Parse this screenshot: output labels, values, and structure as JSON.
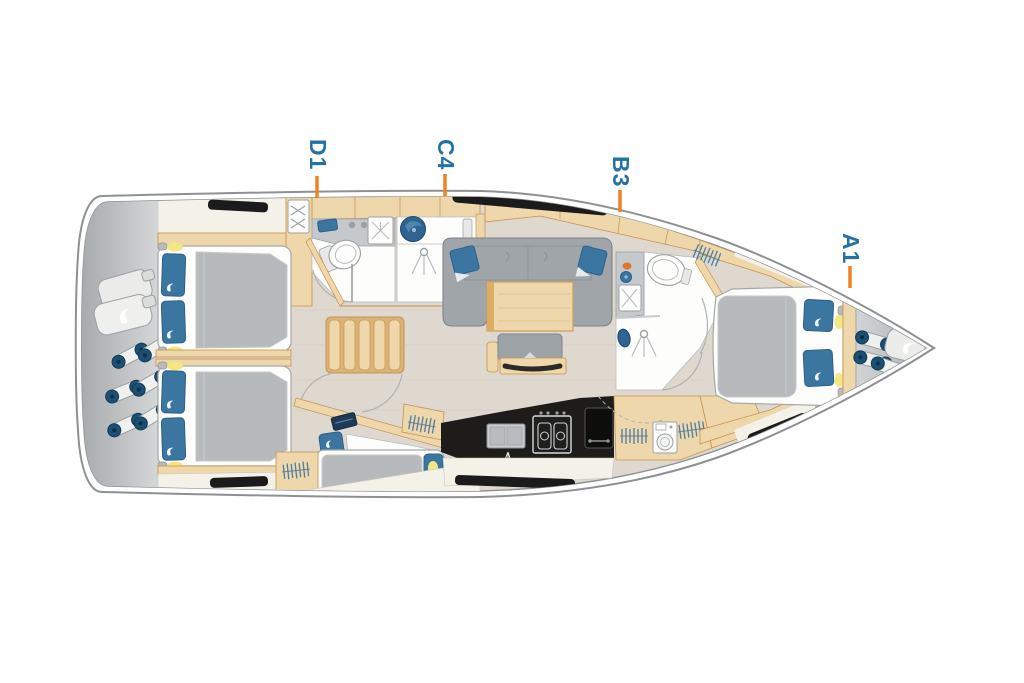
{
  "diagram": {
    "type": "yacht-deck-plan",
    "orientation": "bow-right",
    "labels": {
      "d1": "D1",
      "c4": "C4",
      "b3": "B3",
      "a1": "A1"
    },
    "colors": {
      "label_text": "#2272a4",
      "label_tick": "#f08223",
      "hull_outline": "#8d9193",
      "floor": "#ded8cf",
      "wood": "#eed7ab",
      "wood_outline": "#c9914b",
      "upholstery_gray": "#a0a5aa",
      "mattress_gray": "#b7babc",
      "pillow_blue": "#3a76a0",
      "fender_navy": "#1d4f72",
      "deck_gray": "#c0c3c5",
      "counter_black": "#1d1c1a",
      "reading_light_yellow": "#f2e87f"
    },
    "icons": [
      "shower-head-icon",
      "toilet-icon",
      "sink-icon",
      "washbasin-icon",
      "stove-icon",
      "fridge-icon",
      "galley-sink-icon",
      "washing-machine-icon",
      "hanging-clothes-icon",
      "wardrobe-hanger-icon",
      "fender-icon",
      "fender-bag-icon",
      "reading-light-icon",
      "stairs-icon",
      "window-icon",
      "deck-hatch-icon"
    ]
  }
}
